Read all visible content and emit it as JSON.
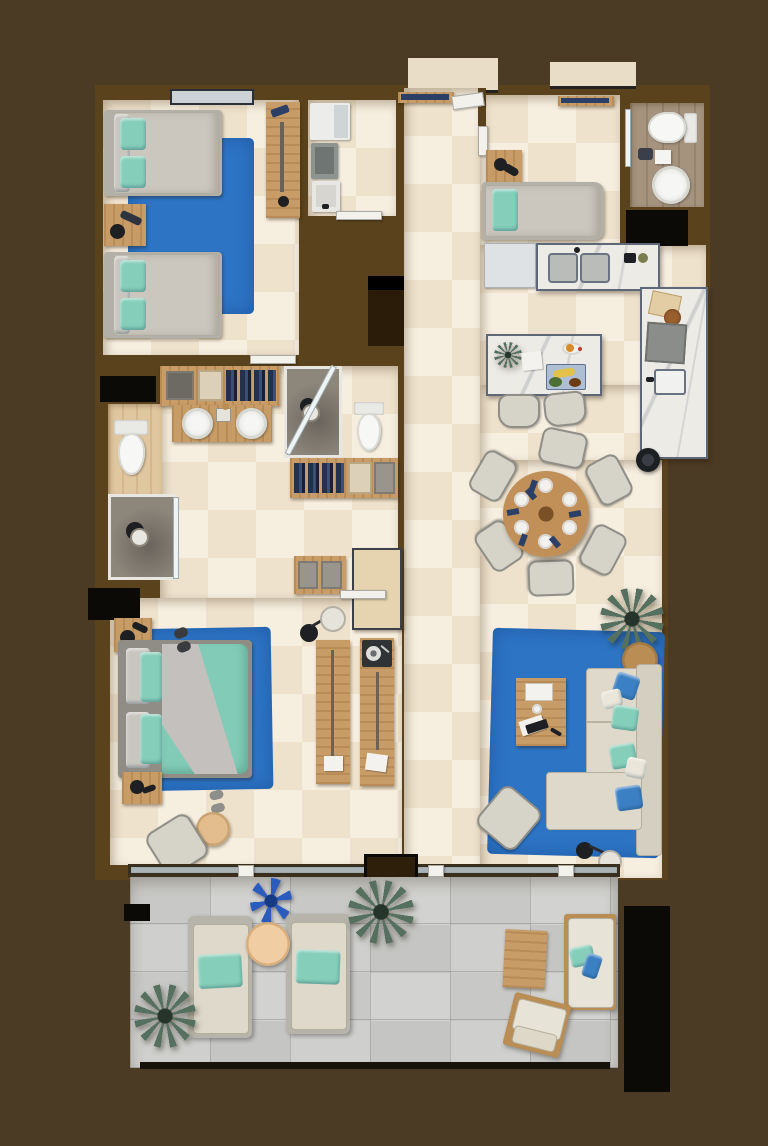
{
  "scene": {
    "type": "3d-rendered apartment floor plan, top-down view",
    "palette": {
      "background": "#4b3a24",
      "walls": "#5a421c",
      "interior_tile": "#f2e7d6",
      "terrace_stone": "#cbcbc9",
      "rug_blue": "#2d74c5",
      "pillow_teal": "#85cfba",
      "pillow_blue": "#3c80c4",
      "wood": "#c79c66",
      "marble_counter": "#edebe6",
      "void_black": "#0b0a07"
    }
  },
  "rooms": [
    {
      "name": "twin-bedroom",
      "position": "top-left",
      "items": [
        "twin bed with mint pillows",
        "twin bed with mint pillows",
        "nightstand with black lamp",
        "blue rug",
        "wall desk with accessories",
        "window"
      ]
    },
    {
      "name": "utility-room",
      "position": "top-center",
      "items": [
        "washing machine",
        "dryer",
        "third appliance",
        "door"
      ]
    },
    {
      "name": "entry-hall",
      "position": "top-center",
      "items": [
        "entry door",
        "wall console with dark items",
        "second wall console"
      ]
    },
    {
      "name": "single-bed-nook",
      "position": "top-right-center",
      "items": [
        "single bed with teal pillow",
        "nightstand with black lamp"
      ]
    },
    {
      "name": "bathroom-top-right",
      "position": "top-right",
      "items": [
        "toilet",
        "round pedestal sink",
        "glass door",
        "dark floor mat",
        "black storage void"
      ]
    },
    {
      "name": "kitchen",
      "position": "right",
      "items": [
        "fridge",
        "marble counter with double sink",
        "marble counter with cooktop",
        "small prep sink",
        "cutting board with food",
        "marble island with fruit, tray of bananas and papers",
        "2 island chairs"
      ]
    },
    {
      "name": "dining-area",
      "position": "center-right",
      "items": [
        "round wooden dining table",
        "6 upholstered chairs",
        "6 place settings with plates and blue napkins",
        "robot vacuum",
        "potted palm"
      ]
    },
    {
      "name": "living-room",
      "position": "right-bottom",
      "items": [
        "blue rug",
        "L-shaped cream sofa with blue and teal pillows",
        "wooden coffee table with books and tray",
        "round wooden side table",
        "lounge chair",
        "black floor lamp with white shade"
      ]
    },
    {
      "name": "bathroom-complex",
      "position": "middle-left",
      "items": [
        "double vanity with two round sinks",
        "toilet",
        "second toilet",
        "walk-in shower with glass door",
        "second walk-in shower",
        "closet rail with hanging clothes",
        "second closet rail",
        "drawer dressers",
        "dark mat",
        "hall bench",
        "black window void"
      ]
    },
    {
      "name": "master-bedroom",
      "position": "bottom-left",
      "items": [
        "double bed with teal duvet and gray throw",
        "blue rug",
        "2 nightstands with black lamps",
        "slippers",
        "round pouf",
        "bedroom chair",
        "floor lamp",
        "two long wooden desk consoles",
        "record player",
        "papers"
      ]
    },
    {
      "name": "terrace",
      "position": "bottom",
      "items": [
        "2 sun loungers with teal pillows",
        "round side table",
        "blue agave plant",
        "2 potted palms",
        "outdoor wooden table",
        "outdoor sofa with white cushions and teal/blue pillows",
        "outdoor armchair",
        "black planter",
        "sliding glass wall"
      ]
    }
  ],
  "counts": {
    "bedrooms": 3,
    "beds": 4,
    "bathrooms": 3,
    "showers": 3,
    "toilets": 3,
    "sinks": 6,
    "blue_rugs": 3,
    "palms_plants": 4
  }
}
